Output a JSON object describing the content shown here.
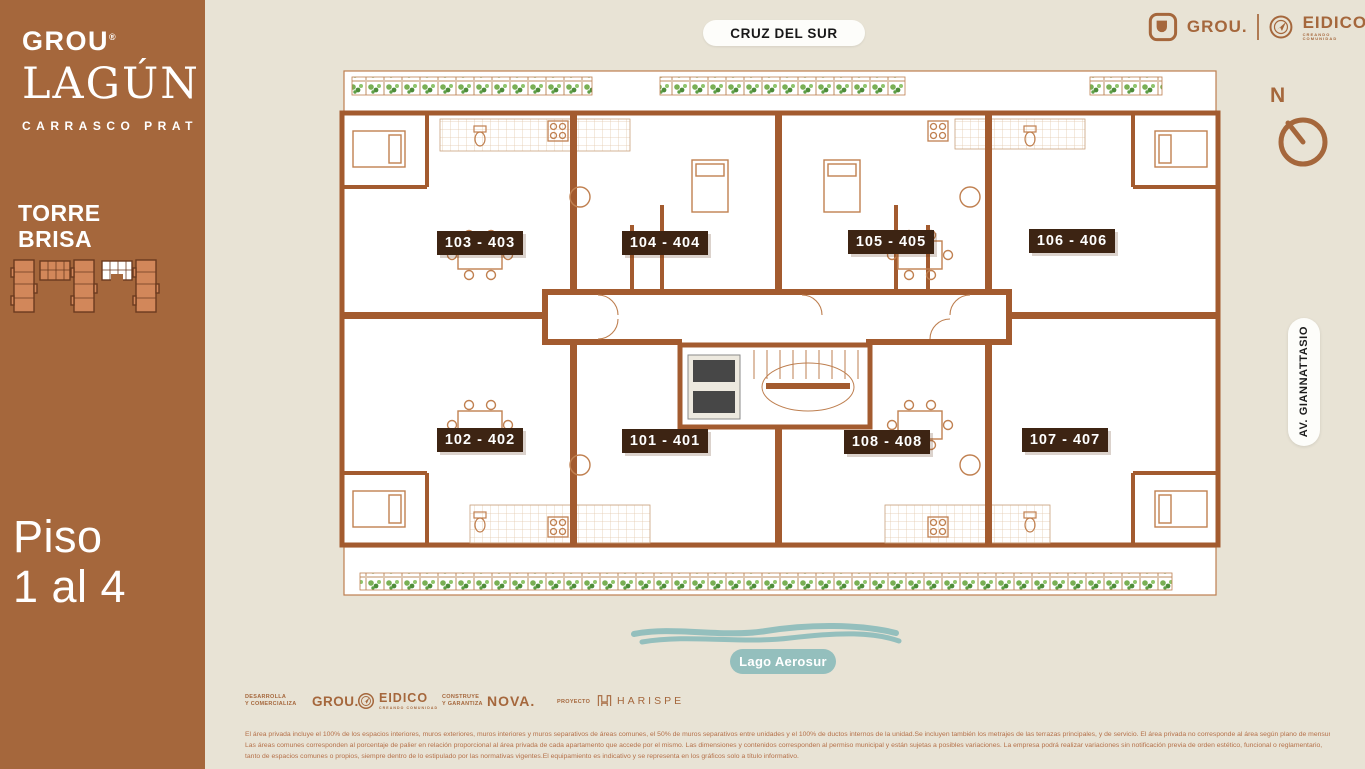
{
  "colors": {
    "sidebar_brown": "#A5673C",
    "background_beige": "#E8E3D5",
    "plan_wall_terracotta": "#A35B2F",
    "furniture_line": "#C08050",
    "unit_badge_dark": "#3D2413",
    "planter_green": "#76AC54",
    "lake_teal": "#94BFBD",
    "legal_text": "#B5714A"
  },
  "brand": {
    "grou": "GROU",
    "registered": "®",
    "lagun": "LAGÚN",
    "subtitle": "CARRASCO PRAT"
  },
  "tower": {
    "line1": "TORRE",
    "line2": "BRISA"
  },
  "floor": {
    "line1": "Piso",
    "line2": "1 al 4"
  },
  "top_street_label": "CRUZ DEL SUR",
  "partners_header": {
    "grou": "GROU.",
    "eidico": "EIDICO",
    "eidico_tagline": "CREANDO COMUNIDAD"
  },
  "compass": {
    "north": "N"
  },
  "right_street_label": "AV. GIANNATTASIO",
  "lake_label": "Lago Aerosur",
  "units": [
    {
      "label": "103 - 403"
    },
    {
      "label": "104 - 404"
    },
    {
      "label": "105 - 405"
    },
    {
      "label": "106 - 406"
    },
    {
      "label": "102 - 402"
    },
    {
      "label": "101 - 401"
    },
    {
      "label": "108 - 408"
    },
    {
      "label": "107 - 407"
    }
  ],
  "footer": {
    "dev_role_line1": "DESARROLLA",
    "dev_role_line2": "Y COMERCIALIZA",
    "dev_brand_1": "GROU.",
    "dev_brand_2": "EIDICO",
    "dev_brand_2_tagline": "CREANDO COMUNIDAD",
    "build_role_line1": "CONSTRUYE",
    "build_role_line2": "Y GARANTIZA",
    "build_brand": "NOVA.",
    "project_role": "PROYECTO",
    "project_brand": "HARISPE",
    "legal": [
      "El área privada incluye el 100% de los espacios interiores, muros exteriores, muros interiores y muros separativos de áreas comunes, el 50% de muros separativos entre unidades y el 100% de ductos internos de la unidad.Se incluyen también los metrajes de las terrazas principales, y de servicio. El área privada no corresponde al área según plano de mensura.",
      "Las áreas comunes corresponden al porcentaje de palier en relación proporcional al área privada de cada apartamento que accede por el mismo. Las dimensiones y contenidos corresponden al permiso municipal y están sujetas a posibles variaciones. La empresa podrá realizar variaciones sin notificación previa de orden estético, funcional o reglamentario,",
      "tanto de espacios comunes o propios, siempre dentro de lo estipulado por las normativas vigentes.El equipamiento es indicativo y se representa en los gráficos solo a título informativo."
    ]
  }
}
